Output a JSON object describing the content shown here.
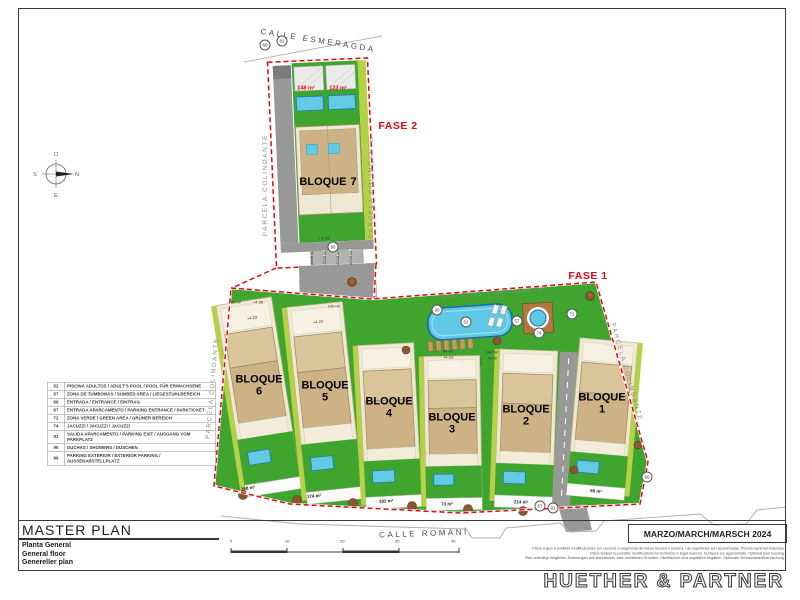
{
  "titleblock": {
    "title": "MASTER PLAN",
    "subtitles": [
      "Planta General",
      "General floor",
      "Genereller plan"
    ],
    "date": "MARZO/MARCH/MARSCH 2024",
    "company": "HUETHER & PARTNER",
    "disclaimer": [
      "Plano sujeto a posibles modificaciones por razones o exigencias de índole técnica o jurídica. Las superficies son aproximadas. Piscina opcional viviendas.",
      "Plans subject to possible modifications for technical or legal reasons. Surfaces are approximate. Optional pool housing.",
      "Plan unterliegt möglichen Änderungen aus technischen oder rechtlichen Gründen. Oberflächen sind ungefähre Angaben. Optionale Schwimmbadüberdachung."
    ]
  },
  "legend": {
    "rows": [
      {
        "code": "52",
        "desc": "PISCINA ADULTOS / ADULT'S POOL / POOL FÜR ERWACHSENE"
      },
      {
        "code": "57",
        "desc": "ZONA DE TUMBONAS / SUNBED AREA / LIEGESTUHLBEREICH"
      },
      {
        "code": "66",
        "desc": "ENTRADA / ENTRANCE / EINTRAG"
      },
      {
        "code": "67",
        "desc": "ENTRADA APARCAMENTO / PARKING ENTRANCE / PARKTICKET"
      },
      {
        "code": "72",
        "desc": "ZONA VERDE / GREEN AREA / GRÜNER BEREICH"
      },
      {
        "code": "74",
        "desc": "JACUZZI / JACUZZI / JACUZZI"
      },
      {
        "code": "81",
        "desc": "SALIDA APARCAMENTO / PARKING EXIT / AUSGANG VOM PARKPLATZ"
      },
      {
        "code": "90",
        "desc": "DUCHAS / SHOWERS / DUSCHEN"
      },
      {
        "code": "96",
        "desc": "PARKING EXTERIOR / EXTERIOR PARKING / AUSSENABSTELLPLATZ"
      }
    ]
  },
  "streets": {
    "top": "CALLE ESMERAGDA",
    "bottom": "CALLE ROMANÍ"
  },
  "phases": {
    "fase1": "FASE 1",
    "fase2": "FASE 2"
  },
  "boundary_label": "PARCELA COLINDANTE",
  "bloques": {
    "word": "BLOQUE",
    "numbers": [
      "1",
      "2",
      "3",
      "4",
      "5",
      "6",
      "7"
    ]
  },
  "areas": {
    "fase2_units": [
      "148 m²",
      "123 m²"
    ],
    "plot_bottom": [
      "168 m²",
      "174 m²",
      "192 m²",
      "73 m²",
      "214 m²",
      "90 m²"
    ],
    "annotations": [
      "56 m²",
      "+4.55",
      "120 m²",
      "44 m²",
      "+4.23",
      "184 m²",
      "+4.40",
      "+4.23",
      "+4.23",
      "+ 3.3m",
      "+4.20"
    ]
  },
  "parking": {
    "stalls": [
      "APAR 01",
      "APAR 02",
      "APAR 03",
      "APAR 04"
    ]
  },
  "markers": {
    "items": [
      "66",
      "81",
      "96",
      "52",
      "90",
      "57",
      "72",
      "74",
      "67",
      "81",
      "66"
    ]
  },
  "scalebar": {
    "ticks": [
      "0",
      "10",
      "20",
      "30",
      "40"
    ]
  },
  "compass": {
    "top": "O",
    "right": "N",
    "bottom": "E",
    "left": "S"
  },
  "colors": {
    "green": "#3fa52f",
    "hedge": "#b5d244",
    "tan": "#cdb286",
    "cream": "#efe8d2",
    "pool": "#63c9e4",
    "pool_border": "#1f7fae",
    "road": "#989896",
    "red": "#e30613"
  }
}
